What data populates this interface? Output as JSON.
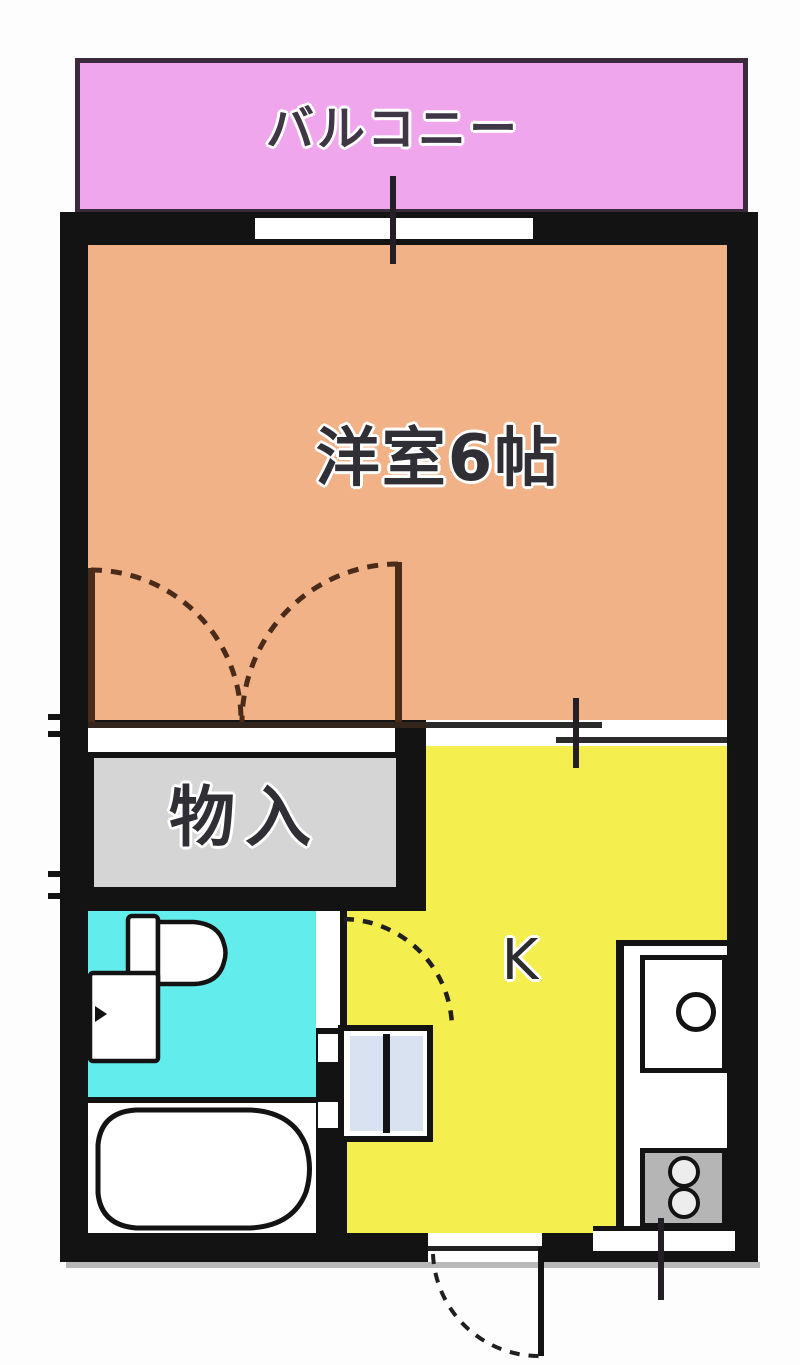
{
  "floorplan": {
    "balcony": {
      "label": "バルコニー"
    },
    "western_room": {
      "label": "洋室6帖"
    },
    "closet": {
      "label": "物入"
    },
    "kitchen": {
      "label": "K"
    },
    "fixtures": {
      "toilet": "toilet",
      "washbasin": "washbasin",
      "bathtub": "bathtub",
      "washing_machine_space": "washing-machine-space",
      "kitchen_sink": "kitchen-sink",
      "stove": "two-burner-stove",
      "entrance_door": "entrance-door-swing",
      "closet_doors": "double-swing-closet-doors",
      "toilet_door": "toilet-door-swing",
      "balcony_window": "balcony-window",
      "kitchen_window": "kitchen-window"
    },
    "colors": {
      "wall": "#131313",
      "balcony": "#f0a6ec",
      "balcony_border": "#3a2a3c",
      "room": "#f0b286",
      "kitchen": "#f4ee4f",
      "toilet": "#63ecec",
      "closet": "#d5d5d5",
      "stove": "#b5b5b5",
      "panel": "#d9e2f0",
      "arc": "#4a2b1a",
      "line": "#2b2b2b",
      "ink": "#2f2f35",
      "shadow": "#b9b9b9"
    }
  }
}
